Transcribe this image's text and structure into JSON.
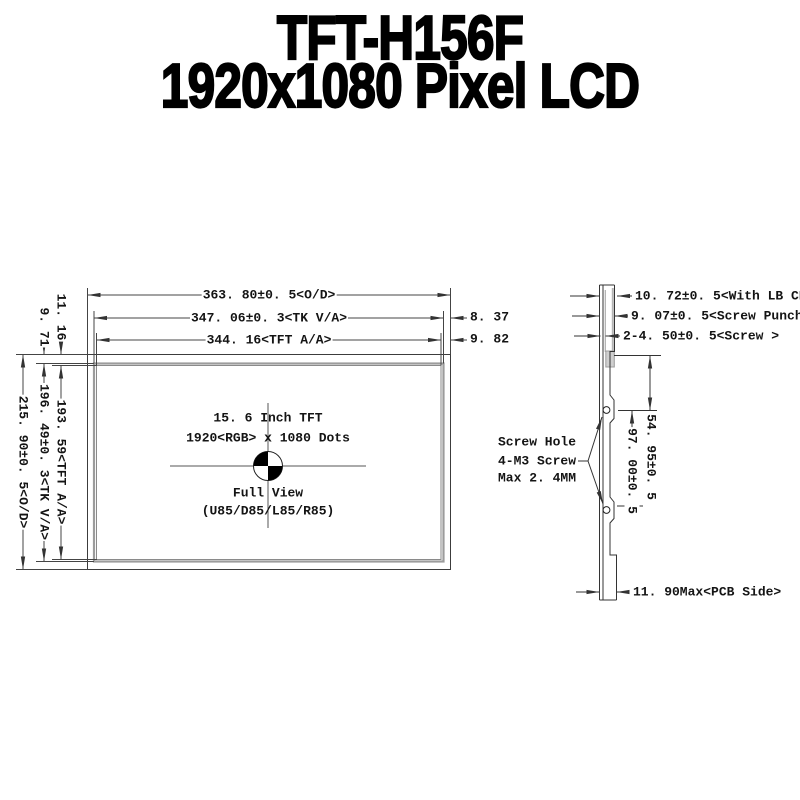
{
  "title": {
    "line1": "TFT-H156F",
    "line2": "1920x1080 Pixel LCD"
  },
  "front_view": {
    "width_dims": {
      "od": "363. 80±0. 5<O/D>",
      "tk": "347. 06±0. 3<TK V/A>",
      "aa": "344. 16<TFT A/A>"
    },
    "right_gap_dims": {
      "tk": "8. 37",
      "aa": "9. 82"
    },
    "top_gap_dims": {
      "aa": "11. 16",
      "tk": "9. 71"
    },
    "height_dims": {
      "od": "215. 90±0. 5<O/D>",
      "tk": "196. 49±0. 3<TK V/A>",
      "aa": "193. 59<TFT A/A>"
    },
    "center_text": {
      "line1": "15. 6 Inch TFT",
      "line2": "1920<RGB> x 1080 Dots",
      "line3": "Full View",
      "line4": "(U85/D85/L85/R85)"
    }
  },
  "side_view": {
    "thickness_dims": {
      "with_lb_cn": "10. 72±0. 5<With LB CN>",
      "screw_punch": "9. 07±0. 5<Screw Punch>",
      "screw": "2-4. 50±0. 5<Screw >"
    },
    "screw_pitch_dims": {
      "top": "54. 95±0. 5",
      "between": "97. 00±0. 5"
    },
    "screw_note": {
      "line1": "Screw Hole",
      "line2": "4-M3 Screw",
      "line3": "Max 2. 4MM"
    },
    "pcb_dim": "11. 90Max<PCB Side>"
  },
  "colors": {
    "line": "#3c3c3c",
    "panel_border_gray": "#9c9c9c",
    "text": "#141414",
    "background": "#ffffff"
  }
}
